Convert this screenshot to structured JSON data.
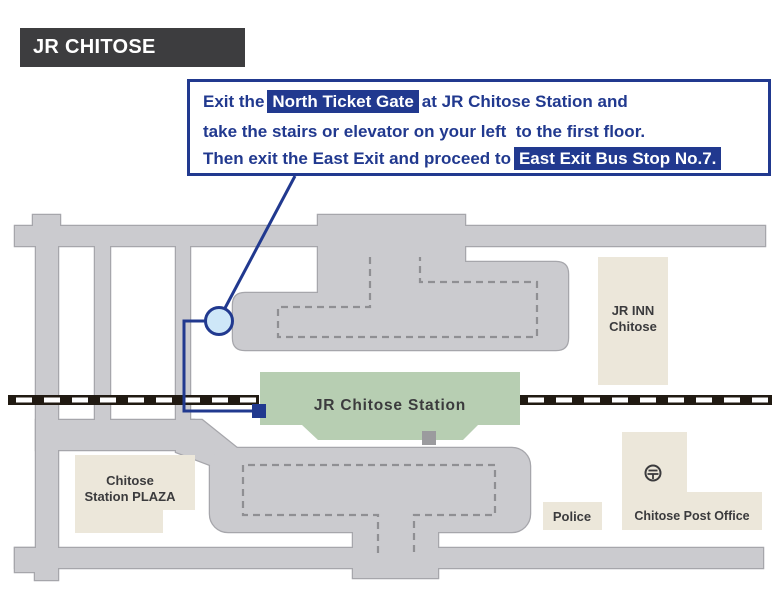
{
  "title": "JR CHITOSE STATION",
  "instructions": {
    "line1_pre": "Exit the",
    "line1_highlight": "North Ticket Gate",
    "line1_post": "at JR Chitose Station and",
    "line2": "take the stairs or elevator on your left  to the first floor.",
    "line3_pre": "Then exit the East Exit and proceed to",
    "line3_highlight": "East Exit Bus Stop No.7."
  },
  "map": {
    "station_label": "JR Chitose Station",
    "jr_inn_line1": "JR INN",
    "jr_inn_line2": "Chitose",
    "plaza_line1": "Chitose",
    "plaza_line2": "Station PLAZA",
    "police_label": "Police",
    "post_office_label": "Chitose Post Office",
    "icons": {
      "postal_mark": "japanese-postal-mark-in-circle",
      "gate_marker": "north-ticket-gate-circle-marker",
      "bus_stop_marker": "east-exit-bus-stop-square-marker"
    }
  },
  "colors": {
    "navy": "#21398F",
    "road_fill": "#CBCBCF",
    "road_stroke": "#A6A6AB",
    "platform_dash": "#8F8F93",
    "station_green": "#B7CEB2",
    "building_beige": "#ECE7DA",
    "rail_black": "#211A12",
    "title_bg": "#3D3D3F",
    "label_gray": "#3B3B3D",
    "marker_fill": "#CEE7F8",
    "exit_square_gray": "#9B9B9E"
  }
}
